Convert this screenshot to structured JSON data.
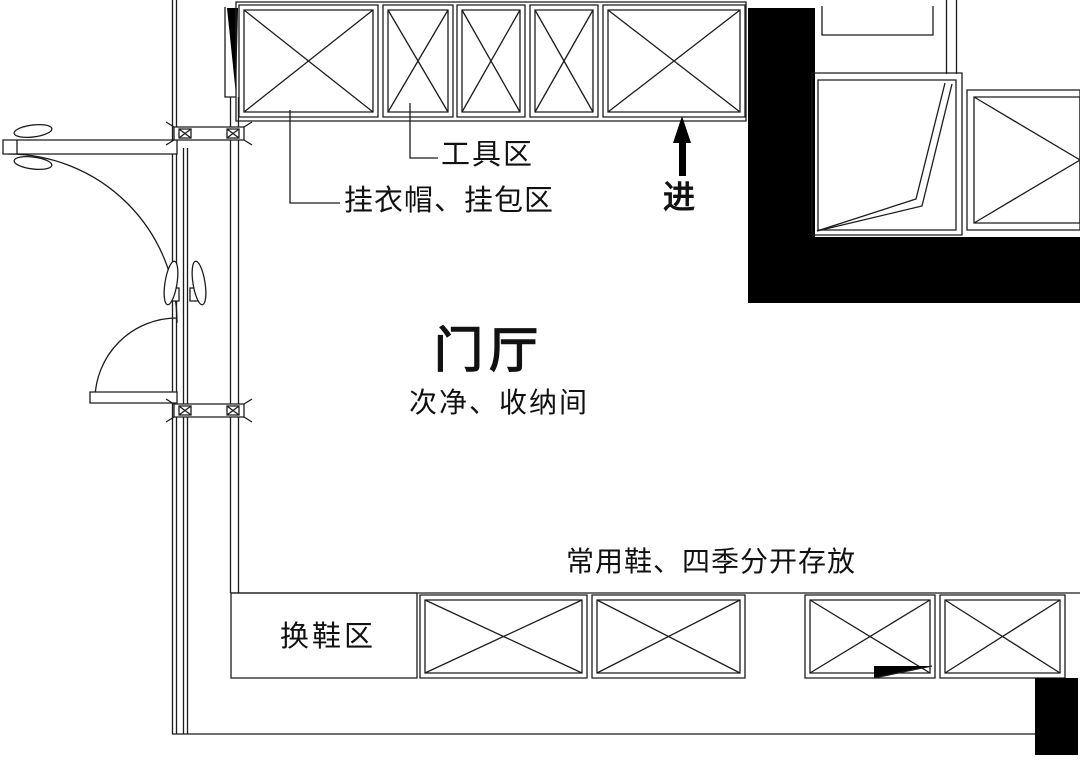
{
  "plan": {
    "room_title": "门厅",
    "room_subtitle": "次净、收纳间",
    "labels": {
      "tool_area": "工具区",
      "coat_bag_area": "挂衣帽、挂包区",
      "entry": "进",
      "shoe_storage_note": "常用鞋、四季分开存放",
      "shoe_change_area": "换鞋区"
    },
    "colors": {
      "line": "#1c1c1c",
      "wall_fill": "#000000",
      "background": "#ffffff"
    }
  }
}
